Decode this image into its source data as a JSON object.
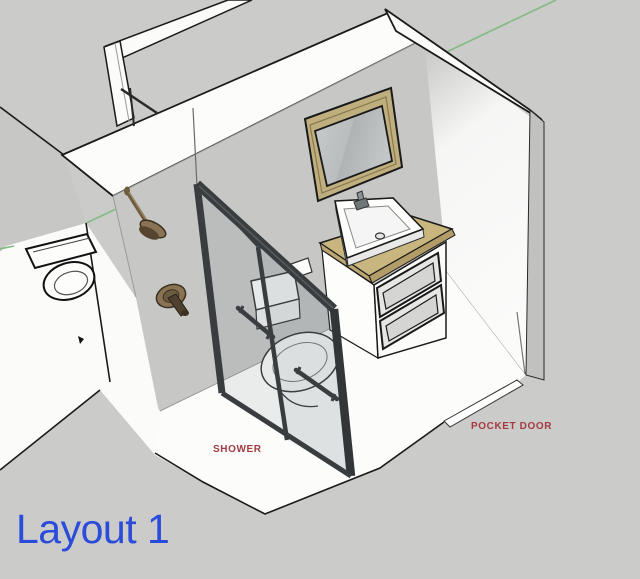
{
  "title": {
    "text": "Layout 1",
    "color": "#2B4BDB"
  },
  "annotations": {
    "shower": {
      "text": "SHOWER",
      "color": "#A33B42"
    },
    "pocket_door": {
      "text": "POCKET DOOR",
      "color": "#A33B42"
    }
  },
  "scene": {
    "view": "3d-perspective bathroom model",
    "background_color": "#CBCBC9",
    "axis_color": "#82BB82",
    "wall_face_color": "#C7C7C5",
    "floor_color": "#FCFCFB",
    "door_frame_color": "#3A3D3F",
    "wood_color": "#C9B67F",
    "bronze_color": "#8A7354",
    "objects": [
      "left-wall-with-doorway",
      "back-right-wall-with-pocket-door-opening",
      "glass-shower-enclosure-with-dark-frame",
      "shower-head-bronze",
      "shower-mixer-valve-bronze",
      "toilet-inside-shower-enclosure",
      "toilet-top-view-adjacent-room",
      "vanity-cabinet-two-drawers",
      "vessel-sink-with-faucet",
      "wood-framed-mirror",
      "pocket-door-floor-threshold",
      "green-axis-line"
    ]
  }
}
